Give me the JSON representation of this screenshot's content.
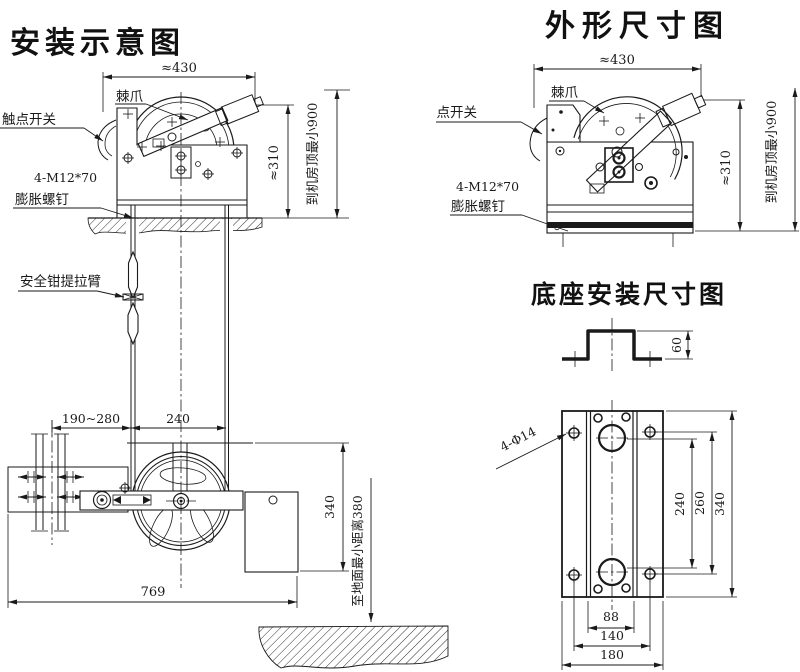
{
  "colors": {
    "ink": "#1a1a1a",
    "paper": "#ffffff"
  },
  "sections": {
    "install": {
      "title": "安装示意图",
      "labels": {
        "pawl": "棘爪",
        "contact_switch": "触点开关",
        "anchor_spec": "4-M12*70",
        "anchor_name": "膨胀螺钉",
        "safety_arm": "安全钳提拉臂"
      },
      "dims": {
        "top_width": "≈430",
        "body_height": "≈310",
        "to_ceiling": "到机房顶最小900",
        "rail_to_rope": "190~280",
        "rope_span": "240",
        "tension_height": "340",
        "total_width": "769",
        "to_floor": "至地面最小距离380"
      }
    },
    "outline": {
      "title": "外形尺寸图",
      "labels": {
        "pawl": "棘爪",
        "contact_switch": "触点开关",
        "anchor_spec": "4-M12*70",
        "anchor_name": "膨胀螺钉"
      },
      "dims": {
        "top_width": "≈430",
        "body_height": "≈310",
        "to_ceiling": "到机房顶最小900"
      }
    },
    "base": {
      "title": "底座安装尺寸图",
      "dims": {
        "channel_height": "60",
        "holes": "4-Φ14",
        "slot_span": "240",
        "hole_span_v": "260",
        "plate_height": "340",
        "inner_width": "88",
        "hole_span_h": "140",
        "plate_width": "180"
      }
    }
  }
}
